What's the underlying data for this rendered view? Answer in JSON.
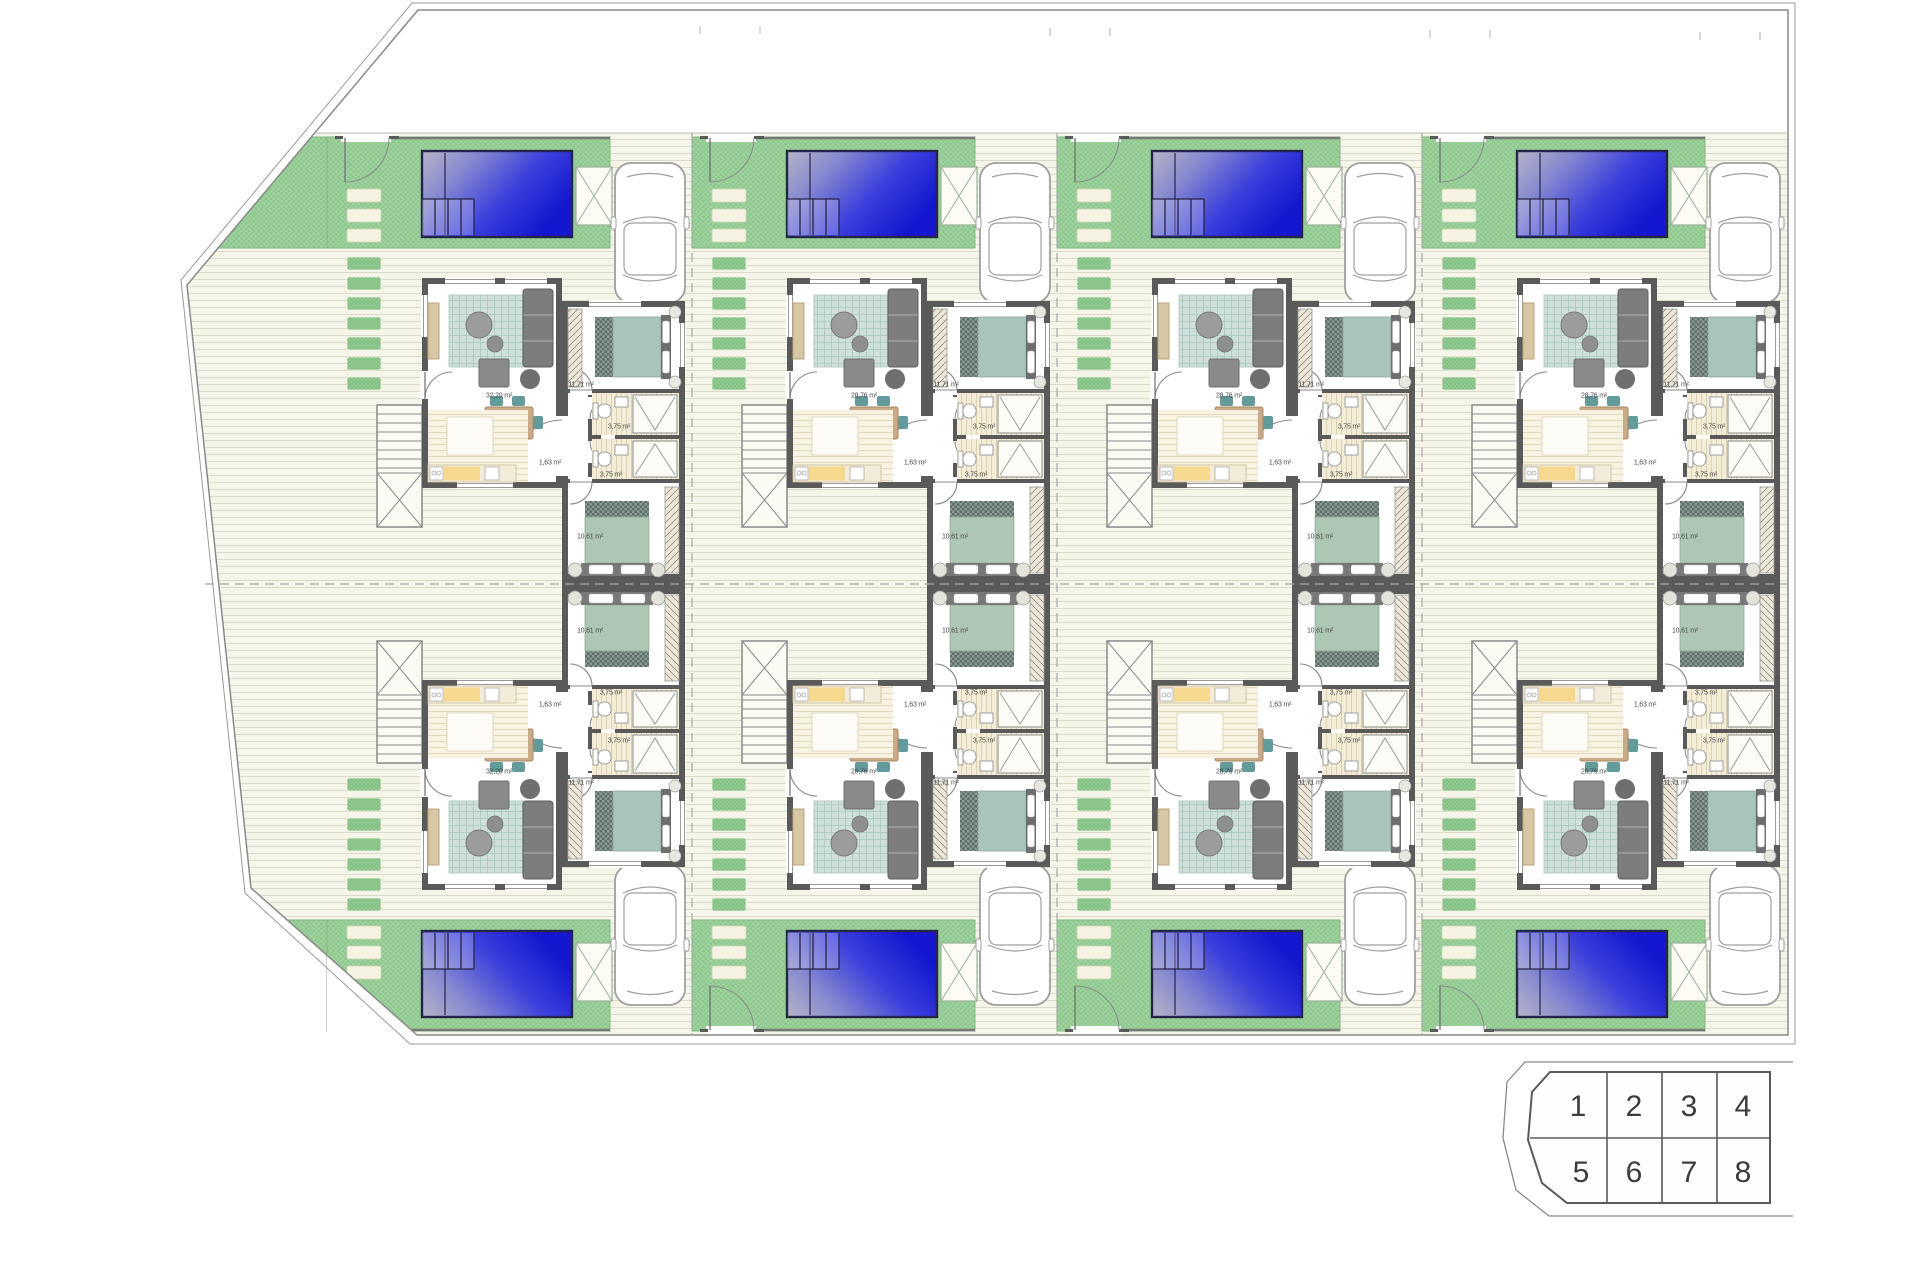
{
  "page": {
    "background": "#ffffff",
    "description_labels": {
      "site": "residential site plan, 8 semi-detached villas with pools"
    }
  },
  "colors": {
    "grass": "#8fc78f",
    "grass_dark": "#84bf84",
    "paving": "#f6f5ea",
    "paving_line": "#dbdacb",
    "wall": "#5a5a5a",
    "pool_light": "#b6b4c8",
    "pool_dark": "#1417cf",
    "bed_teal": "#a9c4bc",
    "bed_sage": "#aec6b4",
    "wood": "#cbab87",
    "kitchen_yellow": "#f6d88e",
    "chair_teal": "#639b9b",
    "boundary": "#8a8a8a"
  },
  "room_labels": [
    {
      "room": "living-room",
      "text_key": "living_area",
      "dx": 172,
      "dy": 263
    },
    {
      "room": "bedroom-1",
      "text": "11,71 m²",
      "dx": 254,
      "dy": 252
    },
    {
      "room": "hall",
      "text": "1,63 m²",
      "dx": 223,
      "dy": 330
    },
    {
      "room": "bathroom-1",
      "text": "3,75 m²",
      "dx": 292,
      "dy": 294
    },
    {
      "room": "bathroom-2",
      "text": "3,75 m²",
      "dx": 284,
      "dy": 342
    },
    {
      "room": "bedroom-2",
      "text": "10,61 m²",
      "dx": 263,
      "dy": 404
    }
  ],
  "units": [
    {
      "number": 1,
      "column": 0,
      "row": "top",
      "living_area": "32,20 m²"
    },
    {
      "number": 2,
      "column": 1,
      "row": "top",
      "living_area": "28,76 m²"
    },
    {
      "number": 3,
      "column": 2,
      "row": "top",
      "living_area": "28,76 m²"
    },
    {
      "number": 4,
      "column": 3,
      "row": "top",
      "living_area": "28,76 m²"
    },
    {
      "number": 5,
      "column": 0,
      "row": "bottom",
      "living_area": "32,20 m²"
    },
    {
      "number": 6,
      "column": 1,
      "row": "bottom",
      "living_area": "28,76 m²"
    },
    {
      "number": 7,
      "column": 2,
      "row": "bottom",
      "living_area": "28,76 m²"
    },
    {
      "number": 8,
      "column": 3,
      "row": "bottom",
      "living_area": "28,76 m²"
    }
  ],
  "layout_constants": {
    "columns_x": [
      327,
      692,
      1057,
      1422
    ],
    "top_origin_y": 133,
    "mirror_y": 1035
  },
  "key_plan": {
    "cells": [
      "1",
      "2",
      "3",
      "4",
      "5",
      "6",
      "7",
      "8"
    ]
  }
}
